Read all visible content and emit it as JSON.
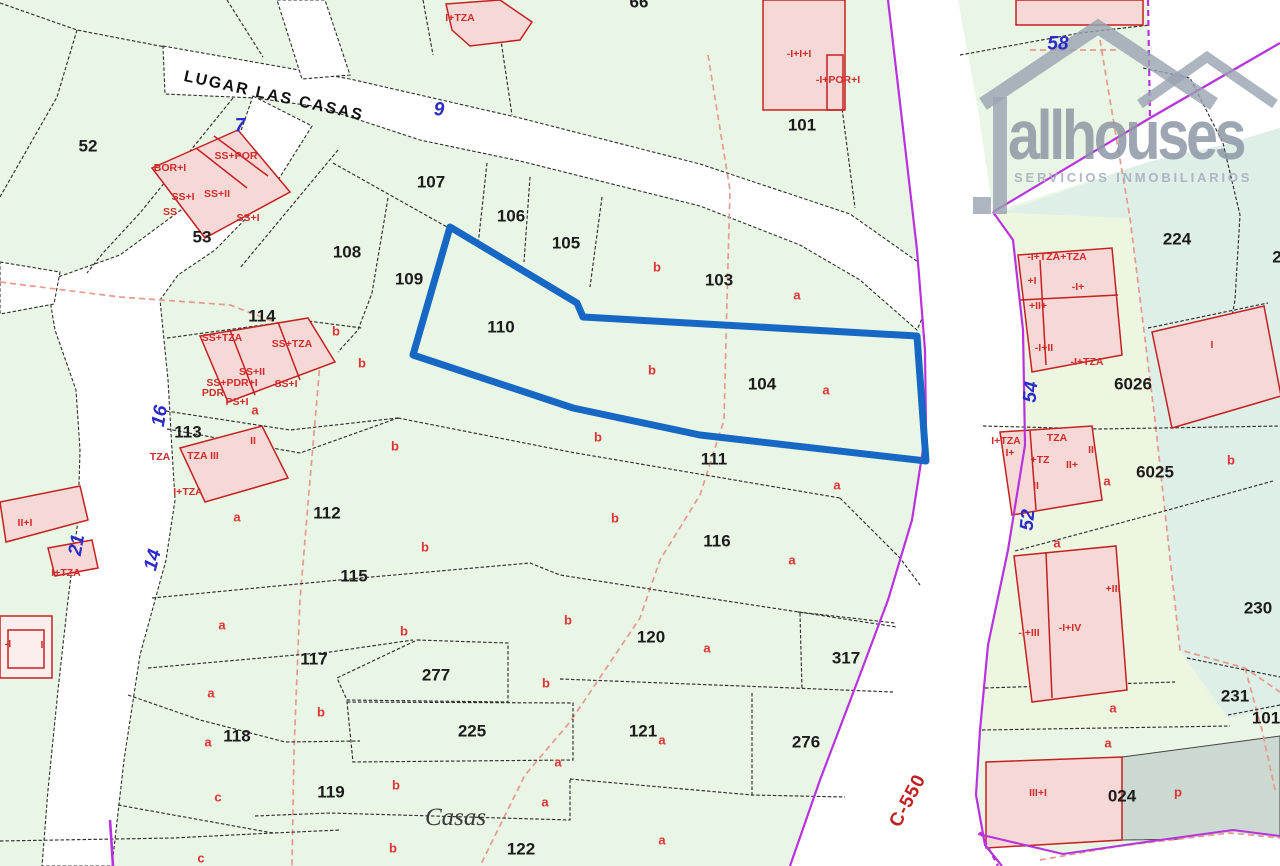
{
  "map": {
    "street_name": "LUGAR LAS CASAS",
    "place_label": "Casas",
    "road_ref": "C-550",
    "logo": {
      "brand": "allhouses",
      "tagline": "SERVICIOS INMOBILIARIOS"
    },
    "colors": {
      "highlight_blue": "#1668c4",
      "road_purple": "#b832de",
      "boundary_salmon": "#e79a8c",
      "building_red": "#c42020",
      "building_fill": "#f6d9d7",
      "parcel_green": "#e9f6e5",
      "parcel_teal": "#ddefe7",
      "parcel_yellowgreen": "#edf6e0",
      "reserved_gray": "#ccd9d1",
      "letter_red": "#e03434",
      "road_number_blue": "#2b2bc8",
      "logo_gray": "#98a2b2"
    },
    "labels": {
      "parcel_numbers": [
        {
          "t": "52",
          "x": 88,
          "y": 146
        },
        {
          "t": "53",
          "x": 202,
          "y": 237
        },
        {
          "t": "107",
          "x": 431,
          "y": 182
        },
        {
          "t": "106",
          "x": 511,
          "y": 216
        },
        {
          "t": "105",
          "x": 566,
          "y": 243
        },
        {
          "t": "108",
          "x": 347,
          "y": 252
        },
        {
          "t": "109",
          "x": 409,
          "y": 279
        },
        {
          "t": "110",
          "x": 501,
          "y": 327
        },
        {
          "t": "103",
          "x": 719,
          "y": 280
        },
        {
          "t": "104",
          "x": 762,
          "y": 384
        },
        {
          "t": "111",
          "x": 714,
          "y": 459
        },
        {
          "t": "112",
          "x": 327,
          "y": 513
        },
        {
          "t": "113",
          "x": 188,
          "y": 432
        },
        {
          "t": "114",
          "x": 262,
          "y": 316
        },
        {
          "t": "115",
          "x": 354,
          "y": 576
        },
        {
          "t": "116",
          "x": 717,
          "y": 541
        },
        {
          "t": "117",
          "x": 314,
          "y": 659
        },
        {
          "t": "118",
          "x": 237,
          "y": 736
        },
        {
          "t": "119",
          "x": 331,
          "y": 792
        },
        {
          "t": "120",
          "x": 651,
          "y": 637
        },
        {
          "t": "121",
          "x": 643,
          "y": 731
        },
        {
          "t": "122",
          "x": 521,
          "y": 849
        },
        {
          "t": "276",
          "x": 806,
          "y": 742
        },
        {
          "t": "277",
          "x": 436,
          "y": 675
        },
        {
          "t": "317",
          "x": 846,
          "y": 658
        },
        {
          "t": "225",
          "x": 472,
          "y": 731
        },
        {
          "t": "224",
          "x": 1177,
          "y": 239
        },
        {
          "t": "6026",
          "x": 1133,
          "y": 384
        },
        {
          "t": "6025",
          "x": 1155,
          "y": 472
        },
        {
          "t": "230",
          "x": 1258,
          "y": 608
        },
        {
          "t": "231",
          "x": 1235,
          "y": 696
        },
        {
          "t": "101",
          "x": 802,
          "y": 125
        },
        {
          "t": "101",
          "x": 1266,
          "y": 718
        },
        {
          "t": "024",
          "x": 1122,
          "y": 796
        },
        {
          "t": "66",
          "x": 639,
          "y": 2
        },
        {
          "t": "2",
          "x": 1277,
          "y": 257
        }
      ],
      "road_numbers": [
        {
          "t": "7",
          "x": 240,
          "y": 126,
          "r": 0
        },
        {
          "t": "9",
          "x": 439,
          "y": 110,
          "r": 0
        },
        {
          "t": "58",
          "x": 1058,
          "y": 44,
          "r": 0
        },
        {
          "t": "16",
          "x": 160,
          "y": 416,
          "r": -80
        },
        {
          "t": "14",
          "x": 153,
          "y": 560,
          "r": -75
        },
        {
          "t": "21",
          "x": 77,
          "y": 545,
          "r": -80
        },
        {
          "t": "54",
          "x": 1031,
          "y": 392,
          "r": -85
        },
        {
          "t": "52",
          "x": 1028,
          "y": 520,
          "r": -85
        }
      ],
      "subparcel_letters": [
        {
          "t": "a",
          "x": 797,
          "y": 295
        },
        {
          "t": "a",
          "x": 826,
          "y": 390
        },
        {
          "t": "a",
          "x": 255,
          "y": 410
        },
        {
          "t": "a",
          "x": 237,
          "y": 517
        },
        {
          "t": "a",
          "x": 837,
          "y": 485
        },
        {
          "t": "a",
          "x": 792,
          "y": 560
        },
        {
          "t": "a",
          "x": 222,
          "y": 625
        },
        {
          "t": "a",
          "x": 211,
          "y": 693
        },
        {
          "t": "a",
          "x": 208,
          "y": 742
        },
        {
          "t": "a",
          "x": 707,
          "y": 648
        },
        {
          "t": "a",
          "x": 662,
          "y": 740
        },
        {
          "t": "a",
          "x": 558,
          "y": 762
        },
        {
          "t": "a",
          "x": 545,
          "y": 802
        },
        {
          "t": "a",
          "x": 662,
          "y": 840
        },
        {
          "t": "a",
          "x": 1107,
          "y": 481
        },
        {
          "t": "a",
          "x": 1057,
          "y": 543
        },
        {
          "t": "a",
          "x": 1113,
          "y": 708
        },
        {
          "t": "a",
          "x": 1108,
          "y": 743
        },
        {
          "t": "b",
          "x": 657,
          "y": 267
        },
        {
          "t": "b",
          "x": 336,
          "y": 331
        },
        {
          "t": "b",
          "x": 362,
          "y": 363
        },
        {
          "t": "b",
          "x": 652,
          "y": 370
        },
        {
          "t": "b",
          "x": 598,
          "y": 437
        },
        {
          "t": "b",
          "x": 395,
          "y": 446
        },
        {
          "t": "b",
          "x": 615,
          "y": 518
        },
        {
          "t": "b",
          "x": 425,
          "y": 547
        },
        {
          "t": "b",
          "x": 568,
          "y": 620
        },
        {
          "t": "b",
          "x": 404,
          "y": 631
        },
        {
          "t": "b",
          "x": 546,
          "y": 683
        },
        {
          "t": "b",
          "x": 321,
          "y": 712
        },
        {
          "t": "b",
          "x": 396,
          "y": 785
        },
        {
          "t": "b",
          "x": 393,
          "y": 848
        },
        {
          "t": "b",
          "x": 1231,
          "y": 460
        },
        {
          "t": "c",
          "x": 218,
          "y": 797
        },
        {
          "t": "c",
          "x": 201,
          "y": 858
        },
        {
          "t": "p",
          "x": 1178,
          "y": 792
        }
      ],
      "building_labels": [
        {
          "t": "BOR+I",
          "x": 170,
          "y": 168
        },
        {
          "t": "SS+POR",
          "x": 236,
          "y": 156
        },
        {
          "t": "SS+II",
          "x": 217,
          "y": 194
        },
        {
          "t": "SS+I",
          "x": 183,
          "y": 197
        },
        {
          "t": "SS",
          "x": 170,
          "y": 212
        },
        {
          "t": "SS+I",
          "x": 248,
          "y": 218
        },
        {
          "t": "SS+TZA",
          "x": 222,
          "y": 338
        },
        {
          "t": "SS+TZA",
          "x": 292,
          "y": 344
        },
        {
          "t": "SS+II",
          "x": 252,
          "y": 372
        },
        {
          "t": "SS+PDR+I",
          "x": 232,
          "y": 383
        },
        {
          "t": "PDR",
          "x": 213,
          "y": 393
        },
        {
          "t": "PS+I",
          "x": 237,
          "y": 402
        },
        {
          "t": "SS+I",
          "x": 286,
          "y": 384
        },
        {
          "t": "II",
          "x": 253,
          "y": 441
        },
        {
          "t": "TZA",
          "x": 160,
          "y": 457
        },
        {
          "t": "TZA III",
          "x": 203,
          "y": 456
        },
        {
          "t": "I+TZA",
          "x": 188,
          "y": 492
        },
        {
          "t": "II+I",
          "x": 25,
          "y": 523
        },
        {
          "t": "I+TZA",
          "x": 66,
          "y": 573
        },
        {
          "t": "-I",
          "x": 8,
          "y": 644
        },
        {
          "t": "I",
          "x": 42,
          "y": 645
        },
        {
          "t": "I+TZA",
          "x": 460,
          "y": 18
        },
        {
          "t": "-I+I+I",
          "x": 799,
          "y": 54
        },
        {
          "t": "-I+POR+I",
          "x": 838,
          "y": 80
        },
        {
          "t": "-I+TZA+TZA",
          "x": 1057,
          "y": 257
        },
        {
          "t": "+I",
          "x": 1032,
          "y": 281
        },
        {
          "t": "-I+",
          "x": 1078,
          "y": 287
        },
        {
          "t": "+II+",
          "x": 1038,
          "y": 306
        },
        {
          "t": "-I+II",
          "x": 1044,
          "y": 348
        },
        {
          "t": "-I+TZA",
          "x": 1087,
          "y": 362
        },
        {
          "t": "I",
          "x": 1212,
          "y": 345
        },
        {
          "t": "I+TZA",
          "x": 1006,
          "y": 441
        },
        {
          "t": "TZA",
          "x": 1057,
          "y": 438
        },
        {
          "t": "I+",
          "x": 1010,
          "y": 453
        },
        {
          "t": "+TZ",
          "x": 1040,
          "y": 460
        },
        {
          "t": "II+",
          "x": 1072,
          "y": 465
        },
        {
          "t": "II",
          "x": 1091,
          "y": 450
        },
        {
          "t": "II",
          "x": 1036,
          "y": 486
        },
        {
          "t": "+III",
          "x": 1113,
          "y": 589
        },
        {
          "t": "-I+IV",
          "x": 1070,
          "y": 628
        },
        {
          "t": "-I+III",
          "x": 1029,
          "y": 633
        },
        {
          "t": "III+I",
          "x": 1038,
          "y": 793
        }
      ]
    }
  }
}
